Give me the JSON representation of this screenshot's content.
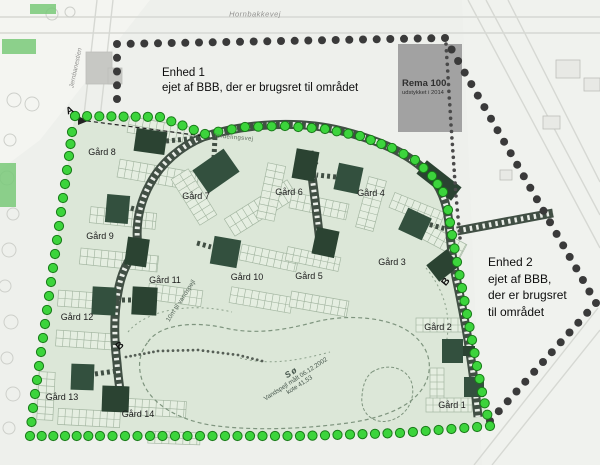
{
  "labels": {
    "road_top": "Hornbakkevej",
    "road_left": "Jernbanestien",
    "ring_road": "fordelingsvej",
    "lake_buffer": "10m til vandspejl",
    "enhed1_title": "Enhed 1",
    "enhed1_body": "ejet af BBB, der er brugsret til området",
    "enhed2_title": "Enhed 2",
    "enhed2_line1": "ejet af BBB,",
    "enhed2_line2": " der er brugsret",
    "enhed2_line3": "til området",
    "rema_title": "Rema 100",
    "rema_subtitle": "udstykket i 2014",
    "lake_name": "Sø",
    "lake_line2": "Vandspejl målt 06.12.2002",
    "lake_line3": "kote 41,53",
    "markers": [
      {
        "text": "A",
        "x": 70,
        "y": 111,
        "rot": -25
      },
      {
        "text": "B",
        "x": 120,
        "y": 346,
        "rot": -40
      },
      {
        "text": "B",
        "x": 446,
        "y": 282,
        "rot": -50
      }
    ]
  },
  "farms": [
    {
      "label": "Gård 1",
      "x": 452,
      "y": 405
    },
    {
      "label": "Gård 2",
      "x": 438,
      "y": 327
    },
    {
      "label": "Gård 3",
      "x": 392,
      "y": 262
    },
    {
      "label": "Gård 4",
      "x": 371,
      "y": 193
    },
    {
      "label": "Gård 5",
      "x": 309,
      "y": 276
    },
    {
      "label": "Gård 6",
      "x": 289,
      "y": 192
    },
    {
      "label": "Gård 7",
      "x": 196,
      "y": 196
    },
    {
      "label": "Gård 8",
      "x": 102,
      "y": 152
    },
    {
      "label": "Gård 9",
      "x": 100,
      "y": 236
    },
    {
      "label": "Gård 10",
      "x": 247,
      "y": 277
    },
    {
      "label": "Gård 11",
      "x": 165,
      "y": 280
    },
    {
      "label": "Gård 12",
      "x": 77,
      "y": 317
    },
    {
      "label": "Gård 13",
      "x": 62,
      "y": 397
    },
    {
      "label": "Gård 14",
      "x": 138,
      "y": 414
    }
  ],
  "colors": {
    "paper": "#eef0ec",
    "estate": "#dce7d8",
    "building_a": "#2b4332",
    "building_b": "#33503e",
    "road": "#414f44",
    "road_dash": "#e9ede7",
    "green_dot": "#3cd43c",
    "green_dot_edge": "#187a18",
    "black_dot": "#3a3a3a",
    "plot_outline": "#9fb29d",
    "plot_fill": "#e7efe2",
    "lake_line": "#7e947e",
    "bg_line": "#d6d8d3",
    "rema_box": "#9b9b9b",
    "tree_line": "#cdcfca"
  },
  "geometry": {
    "bg_shades": [
      {
        "pts": [
          [
            0,
            0
          ],
          [
            150,
            0
          ],
          [
            40,
            140
          ],
          [
            0,
            170
          ]
        ],
        "fill": "#f6f7f4",
        "op": 0.7
      },
      {
        "pts": [
          [
            462,
            0
          ],
          [
            600,
            0
          ],
          [
            600,
            465
          ],
          [
            482,
            465
          ]
        ],
        "fill": "#f2f3f0",
        "op": 0.6
      }
    ],
    "bg_lines": [
      [
        0,
        17,
        600,
        17
      ],
      [
        0,
        33,
        600,
        33
      ],
      [
        97,
        0,
        62,
        310
      ],
      [
        113,
        0,
        80,
        300
      ],
      [
        468,
        0,
        600,
        248
      ],
      [
        486,
        0,
        600,
        215
      ],
      [
        508,
        0,
        600,
        182
      ],
      [
        598,
        308,
        474,
        465
      ],
      [
        600,
        330,
        492,
        465
      ]
    ],
    "trees": [
      [
        14,
        100,
        7
      ],
      [
        32,
        104,
        7
      ],
      [
        10,
        140,
        6
      ],
      [
        7,
        178,
        7
      ],
      [
        13,
        214,
        6
      ],
      [
        9,
        250,
        7
      ],
      [
        5,
        286,
        6
      ],
      [
        11,
        322,
        7
      ],
      [
        7,
        358,
        6
      ],
      [
        13,
        394,
        7
      ],
      [
        9,
        428,
        6
      ],
      [
        52,
        14,
        6
      ],
      [
        70,
        12,
        5
      ]
    ],
    "bg_buildings": [
      [
        86,
        52,
        26,
        32
      ],
      [
        108,
        68,
        14,
        16
      ],
      [
        556,
        60,
        24,
        18
      ],
      [
        584,
        78,
        16,
        13
      ],
      [
        543,
        116,
        17,
        13
      ],
      [
        500,
        170,
        12,
        10
      ]
    ],
    "green_patches": [
      [
        2,
        39,
        34,
        15
      ],
      [
        0,
        163,
        16,
        44
      ],
      [
        30,
        4,
        26,
        10
      ]
    ],
    "estate": [
      [
        75,
        116
      ],
      [
        160,
        117
      ],
      [
        205,
        134
      ],
      [
        245,
        127
      ],
      [
        285,
        126
      ],
      [
        325,
        129
      ],
      [
        360,
        136
      ],
      [
        392,
        148
      ],
      [
        415,
        160
      ],
      [
        432,
        176
      ],
      [
        443,
        192
      ],
      [
        448,
        210
      ],
      [
        452,
        235
      ],
      [
        457,
        262
      ],
      [
        462,
        288
      ],
      [
        467,
        314
      ],
      [
        472,
        340
      ],
      [
        477,
        366
      ],
      [
        482,
        392
      ],
      [
        490,
        426
      ],
      [
        400,
        433
      ],
      [
        300,
        436
      ],
      [
        200,
        436
      ],
      [
        100,
        436
      ],
      [
        30,
        436
      ],
      [
        33,
        408
      ],
      [
        37,
        380
      ],
      [
        41,
        352
      ],
      [
        45,
        324
      ],
      [
        49,
        296
      ],
      [
        53,
        268
      ],
      [
        57,
        240
      ],
      [
        61,
        212
      ],
      [
        65,
        184
      ],
      [
        69,
        156
      ],
      [
        72,
        132
      ]
    ],
    "rema_box": [
      398,
      44,
      64,
      88
    ],
    "black_dots": [
      [
        117,
        99
      ],
      [
        117,
        44
      ],
      [
        445,
        38
      ],
      [
        596,
        303
      ],
      [
        490,
        421
      ]
    ],
    "small_dots": [
      [
        446,
        44
      ],
      [
        451,
        125
      ],
      [
        456,
        196
      ],
      [
        460,
        238
      ]
    ],
    "path_dots": [
      [
        126,
        357
      ],
      [
        158,
        351
      ],
      [
        198,
        350
      ],
      [
        238,
        355
      ],
      [
        262,
        361
      ]
    ],
    "roads": [
      {
        "d": "M 203 137 C 250 122 302 121 342 131 C 378 140 408 153 427 172 C 441 186 447 203 449 223 C 451 244 452 259 456 277 C 461 300 465 321 469 346 C 473 371 476 396 478 417"
      },
      {
        "d": "M 203 137 C 181 146 161 163 150 184 C 140 202 135 224 138 248 C 127 261 121 274 118 292 C 114 313 114 339 117 363 C 118 377 120 390 121 397"
      },
      {
        "d": "M 309 151 C 313 185 318 221 321 252"
      },
      {
        "d": "M 457 231 L 553 213"
      }
    ],
    "spurs": [
      [
        166,
        141,
        199,
        138
      ],
      [
        214,
        158,
        215,
        136
      ],
      [
        317,
        165,
        310,
        160
      ],
      [
        336,
        177,
        317,
        175
      ],
      [
        197,
        243,
        211,
        247
      ],
      [
        116,
        300,
        131,
        300
      ],
      [
        95,
        374,
        116,
        371
      ],
      [
        424,
        223,
        446,
        229
      ],
      [
        131,
        208,
        138,
        210
      ],
      [
        462,
        350,
        472,
        350
      ]
    ],
    "aline": "M 80 120 L 203 136",
    "arrow": [
      [
        78,
        116
      ],
      [
        88,
        121
      ],
      [
        78,
        125
      ]
    ],
    "lake": "M 148 342 C 158 326 190 320 225 328 C 255 335 285 330 315 322 C 345 314 390 316 412 334 C 430 348 434 368 424 386 C 410 410 375 420 340 424 C 300 429 250 431 210 425 C 176 419 150 403 142 380 C 137 364 140 352 148 342 Z",
    "island": "M 372 372 C 388 362 408 368 412 384 C 416 402 404 418 388 421 C 372 424 360 412 362 396 C 363 384 366 377 372 372 Z",
    "buffers": [
      "M 128 332 C 146 310 190 302 232 312",
      "M 426 268 C 444 290 452 316 446 344",
      "M 240 358 C 270 366 300 360 330 352"
    ],
    "buildings": [
      [
        135,
        130,
        31,
        23,
        8
      ],
      [
        197,
        157,
        38,
        28,
        -35
      ],
      [
        294,
        150,
        23,
        30,
        10
      ],
      [
        336,
        165,
        25,
        27,
        12
      ],
      [
        417,
        172,
        44,
        17,
        38
      ],
      [
        106,
        195,
        23,
        28,
        5
      ],
      [
        126,
        238,
        22,
        28,
        8
      ],
      [
        212,
        238,
        27,
        28,
        10
      ],
      [
        314,
        229,
        23,
        27,
        12
      ],
      [
        402,
        212,
        26,
        24,
        25
      ],
      [
        430,
        255,
        26,
        21,
        -38
      ],
      [
        92,
        287,
        24,
        28,
        3
      ],
      [
        132,
        287,
        25,
        28,
        3
      ],
      [
        71,
        364,
        23,
        26,
        2
      ],
      [
        102,
        386,
        27,
        26,
        2
      ],
      [
        442,
        339,
        21,
        24,
        0
      ],
      [
        463,
        346,
        12,
        10,
        0
      ],
      [
        464,
        377,
        20,
        20,
        0
      ]
    ],
    "clusters": [
      [
        128,
        122,
        64,
        16,
        10
      ],
      [
        118,
        166,
        80,
        18,
        10
      ],
      [
        224,
        198,
        74,
        20,
        -32
      ],
      [
        184,
        170,
        20,
        54,
        -32
      ],
      [
        90,
        210,
        66,
        16,
        6
      ],
      [
        80,
        252,
        78,
        16,
        6
      ],
      [
        262,
        164,
        18,
        56,
        12
      ],
      [
        290,
        198,
        58,
        16,
        12
      ],
      [
        362,
        178,
        18,
        52,
        15
      ],
      [
        390,
        202,
        54,
        16,
        22
      ],
      [
        416,
        232,
        50,
        16,
        28
      ],
      [
        240,
        250,
        58,
        16,
        12
      ],
      [
        230,
        292,
        62,
        16,
        10
      ],
      [
        148,
        287,
        54,
        16,
        8
      ],
      [
        286,
        252,
        54,
        14,
        12
      ],
      [
        290,
        296,
        58,
        16,
        10
      ],
      [
        58,
        292,
        54,
        16,
        4
      ],
      [
        56,
        332,
        58,
        16,
        4
      ],
      [
        38,
        372,
        16,
        48,
        3
      ],
      [
        58,
        410,
        62,
        16,
        3
      ],
      [
        128,
        400,
        58,
        16,
        3
      ],
      [
        148,
        432,
        52,
        12,
        2
      ],
      [
        416,
        318,
        50,
        14,
        0
      ],
      [
        430,
        368,
        14,
        42,
        0
      ],
      [
        426,
        398,
        46,
        14,
        0
      ]
    ]
  }
}
